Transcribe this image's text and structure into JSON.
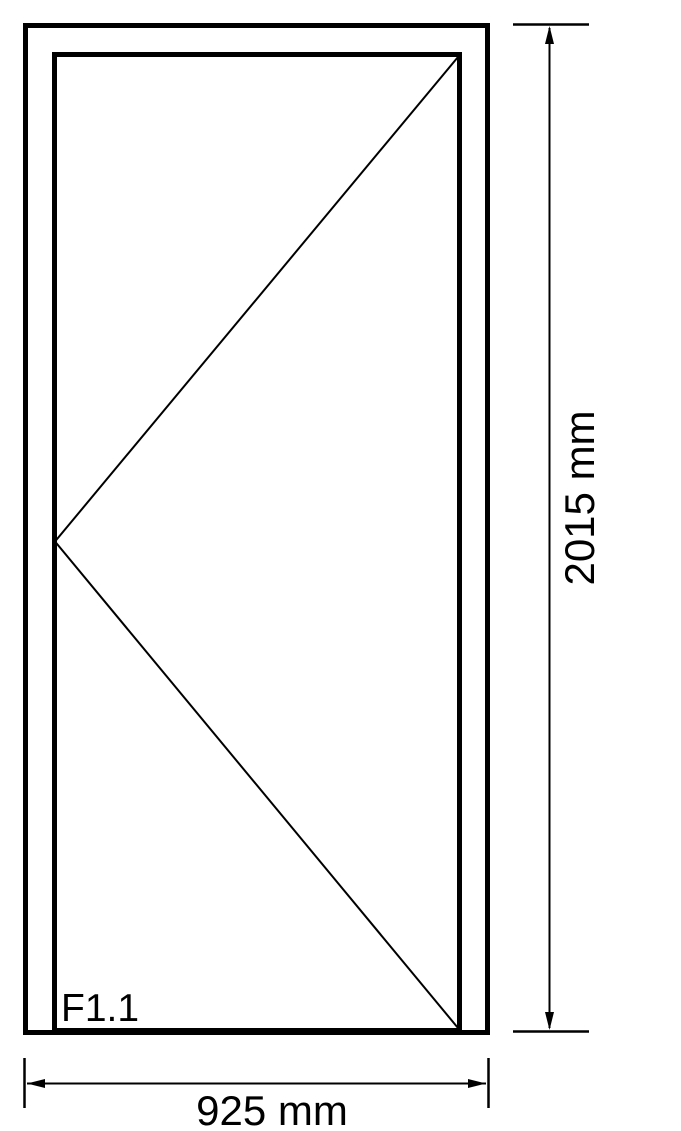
{
  "page": {
    "background_color": "#ffffff",
    "line_color": "#000000"
  },
  "drawing": {
    "type": "door-elevation-technical-drawing",
    "frame_label": "F1.1",
    "height_dimension_label": "2015 mm",
    "width_dimension_label": "925 mm"
  }
}
